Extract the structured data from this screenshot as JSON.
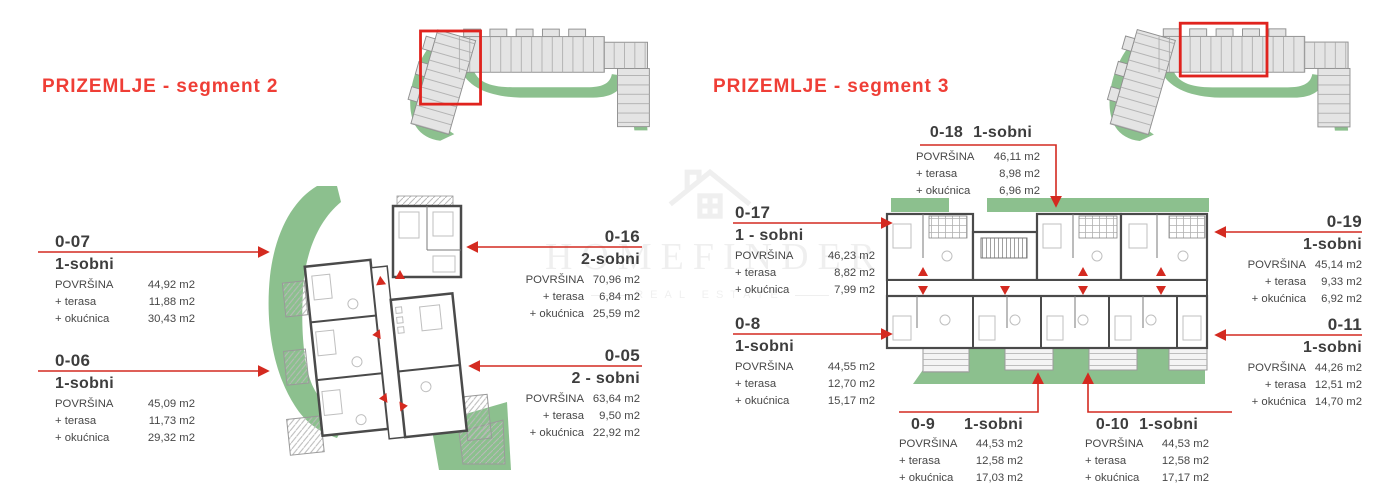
{
  "watermark": {
    "brand": "HOMEFINDER",
    "tagline": "REAL ESTATE"
  },
  "colors": {
    "accent_red": "#ef3e36",
    "leader_red": "#d42a20",
    "plan_green": "#8cc08e"
  },
  "segment2": {
    "title": "PRIZEMLJE - segment 2",
    "units": [
      {
        "id": "0-07",
        "type": "1-sobni",
        "rows": [
          {
            "label": "POVRŠINA",
            "value": "44,92 m2"
          },
          {
            "label": "+ terasa",
            "value": "11,88 m2"
          },
          {
            "label": "+ okućnica",
            "value": "30,43 m2"
          }
        ]
      },
      {
        "id": "0-06",
        "type": "1-sobni",
        "rows": [
          {
            "label": "POVRŠINA",
            "value": "45,09 m2"
          },
          {
            "label": "+ terasa",
            "value": "11,73 m2"
          },
          {
            "label": "+ okućnica",
            "value": "29,32 m2"
          }
        ]
      },
      {
        "id": "0-16",
        "type": "2-sobni",
        "rows": [
          {
            "label": "POVRŠINA",
            "value": "70,96 m2"
          },
          {
            "label": "+ terasa",
            "value": "6,84 m2"
          },
          {
            "label": "+ okućnica",
            "value": "25,59 m2"
          }
        ]
      },
      {
        "id": "0-05",
        "type": "2 - sobni",
        "rows": [
          {
            "label": "POVRŠINA",
            "value": "63,64 m2"
          },
          {
            "label": "+ terasa",
            "value": "9,50 m2"
          },
          {
            "label": "+ okućnica",
            "value": "22,92 m2"
          }
        ]
      }
    ]
  },
  "segment3": {
    "title": "PRIZEMLJE - segment 3",
    "units": [
      {
        "id": "0-18",
        "type": "1-sobni",
        "rows": [
          {
            "label": "POVRŠINA",
            "value": "46,11 m2"
          },
          {
            "label": "+ terasa",
            "value": "8,98 m2"
          },
          {
            "label": "+ okućnica",
            "value": "6,96 m2"
          }
        ]
      },
      {
        "id": "0-17",
        "type": "1 - sobni",
        "rows": [
          {
            "label": "POVRŠINA",
            "value": "46,23 m2"
          },
          {
            "label": "+ terasa",
            "value": "8,82 m2"
          },
          {
            "label": "+ okućnica",
            "value": "7,99 m2"
          }
        ]
      },
      {
        "id": "0-8",
        "type": "1-sobni",
        "rows": [
          {
            "label": "POVRŠINA",
            "value": "44,55 m2"
          },
          {
            "label": "+ terasa",
            "value": "12,70 m2"
          },
          {
            "label": "+ okućnica",
            "value": "15,17 m2"
          }
        ]
      },
      {
        "id": "0-19",
        "type": "1-sobni",
        "rows": [
          {
            "label": "POVRŠINA",
            "value": "45,14 m2"
          },
          {
            "label": "+ terasa",
            "value": "9,33 m2"
          },
          {
            "label": "+ okućnica",
            "value": "6,92 m2"
          }
        ]
      },
      {
        "id": "0-11",
        "type": "1-sobni",
        "rows": [
          {
            "label": "POVRŠINA",
            "value": "44,26 m2"
          },
          {
            "label": "+ terasa",
            "value": "12,51 m2"
          },
          {
            "label": "+ okućnica",
            "value": "14,70 m2"
          }
        ]
      },
      {
        "id": "0-9",
        "type": "1-sobni",
        "rows": [
          {
            "label": "POVRŠINA",
            "value": "44,53 m2"
          },
          {
            "label": "+ terasa",
            "value": "12,58 m2"
          },
          {
            "label": "+ okućnica",
            "value": "17,03 m2"
          }
        ]
      },
      {
        "id": "0-10",
        "type": "1-sobni",
        "rows": [
          {
            "label": "POVRŠINA",
            "value": "44,53 m2"
          },
          {
            "label": "+ terasa",
            "value": "12,58 m2"
          },
          {
            "label": "+ okućnica",
            "value": "17,17 m2"
          }
        ]
      }
    ]
  }
}
